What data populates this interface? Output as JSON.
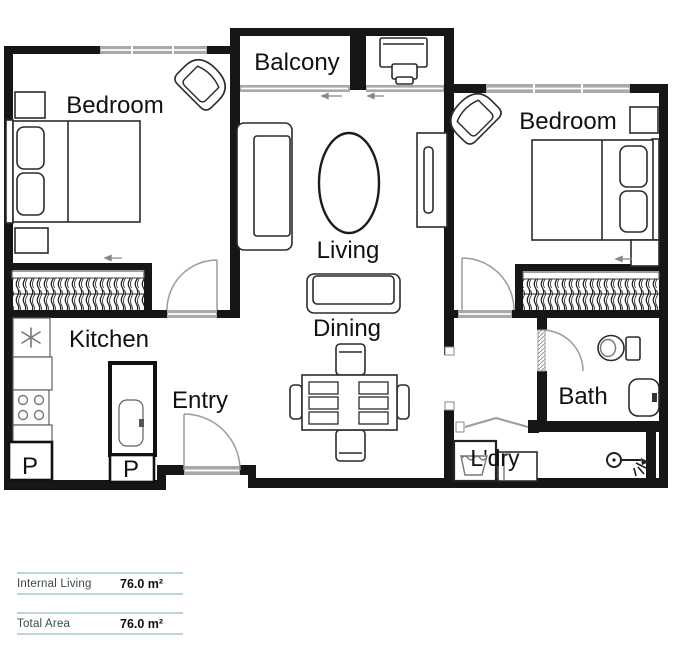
{
  "plan": {
    "rooms": {
      "bedroom_left": "Bedroom",
      "balcony": "Balcony",
      "bedroom_right": "Bedroom",
      "living": "Living",
      "dining": "Dining",
      "kitchen": "Kitchen",
      "entry": "Entry",
      "bath": "Bath",
      "laundry": "L'dry",
      "pantry_left": "P",
      "pantry_island": "P"
    }
  },
  "area_table": {
    "rows": [
      {
        "label": "Internal Living",
        "value": "76.0 m²"
      },
      {
        "label": "Total Area",
        "value": "76.0 m²"
      }
    ]
  },
  "colors": {
    "wall": "#161616",
    "window_fill": "#a9a9a9",
    "door_line": "#9a9a9a",
    "furniture_line": "#2b2b2b",
    "label_color": "#111111",
    "table_line": "#b9d9d3",
    "table_label_color": "#3c484c"
  }
}
